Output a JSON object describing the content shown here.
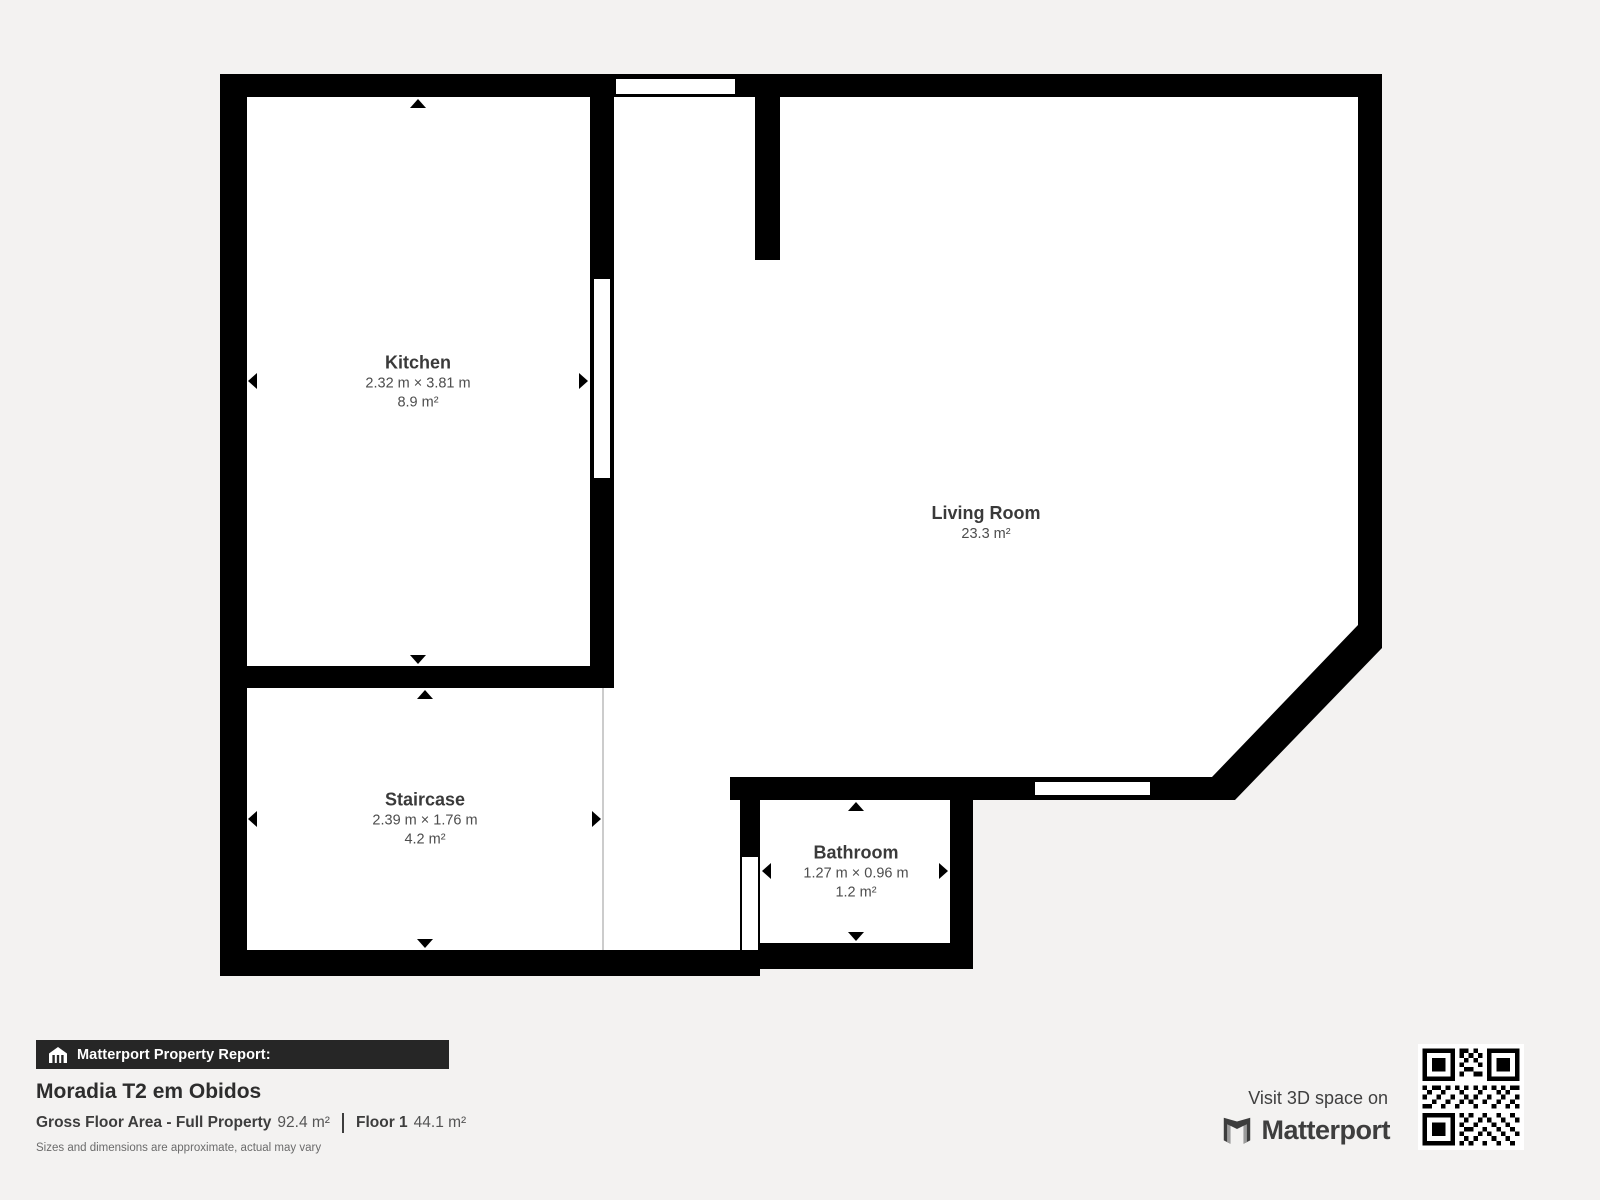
{
  "plan": {
    "rooms": {
      "kitchen": {
        "name": "Kitchen",
        "dimensions": "2.32 m × 3.81 m",
        "area": "8.9 m²"
      },
      "living_room": {
        "name": "Living Room",
        "area": "23.3 m²"
      },
      "staircase": {
        "name": "Staircase",
        "dimensions": "2.39 m × 1.76 m",
        "area": "4.2 m²"
      },
      "bathroom": {
        "name": "Bathroom",
        "dimensions": "1.27 m × 0.96 m",
        "area": "1.2 m²"
      }
    },
    "colors": {
      "wall": "#000000",
      "floor": "#ffffff",
      "background": "#f3f2f1",
      "room_boundary_line": "#cccccc"
    }
  },
  "footer": {
    "report_label": "Matterport Property Report:",
    "property_title": "Moradia T2 em Obidos",
    "gross_floor_area_label": "Gross Floor Area - Full Property",
    "gross_floor_area_value": "92.4 m²",
    "floor_label": "Floor 1",
    "floor_value": "44.1 m²",
    "disclaimer": "Sizes and dimensions are approximate, actual may vary",
    "visit_text": "Visit 3D space on",
    "brand_name": "Matterport",
    "icons": {
      "report_bar": "house-icon",
      "brand": "matterport-logo-icon",
      "qr": "qr-code"
    }
  }
}
